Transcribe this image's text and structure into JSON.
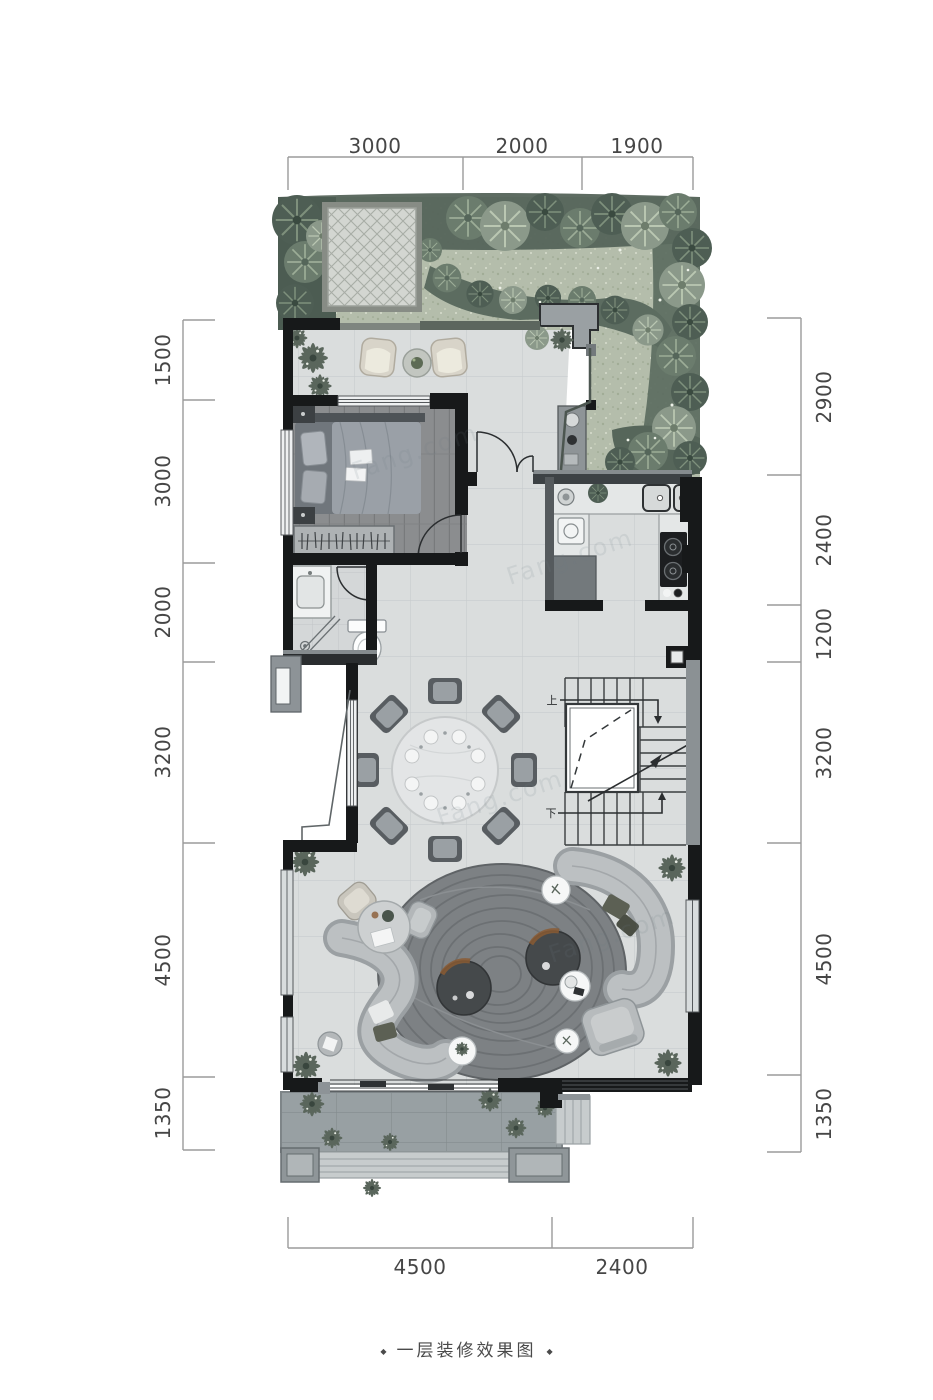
{
  "caption": {
    "text": "一层装修效果图",
    "left_dot": "◆",
    "right_dot": "◆"
  },
  "dimensions": {
    "top": [
      "3000",
      "2000",
      "1900"
    ],
    "left": [
      "1500",
      "3000",
      "2000",
      "3200",
      "4500",
      "1350"
    ],
    "right": [
      "2900",
      "2400",
      "1200",
      "3200",
      "4500",
      "1350"
    ],
    "bottom": [
      "4500",
      "2400"
    ]
  },
  "stairs": {
    "up_label": "上",
    "down_label": "下"
  },
  "watermark": {
    "text": "Fang.com"
  },
  "colors": {
    "wall": "#1a1c1e",
    "wall_gray": "#8d9397",
    "floor_marble": "#dadddd",
    "floor_wood": "#8b8d8f",
    "lawn": "#b4bdab",
    "tree_dark": "#4e5e54",
    "porch": "#98a0a3",
    "rug": "#7d8184",
    "sofa": "#b7bbbd",
    "accent_rust": "#8a5a33"
  }
}
